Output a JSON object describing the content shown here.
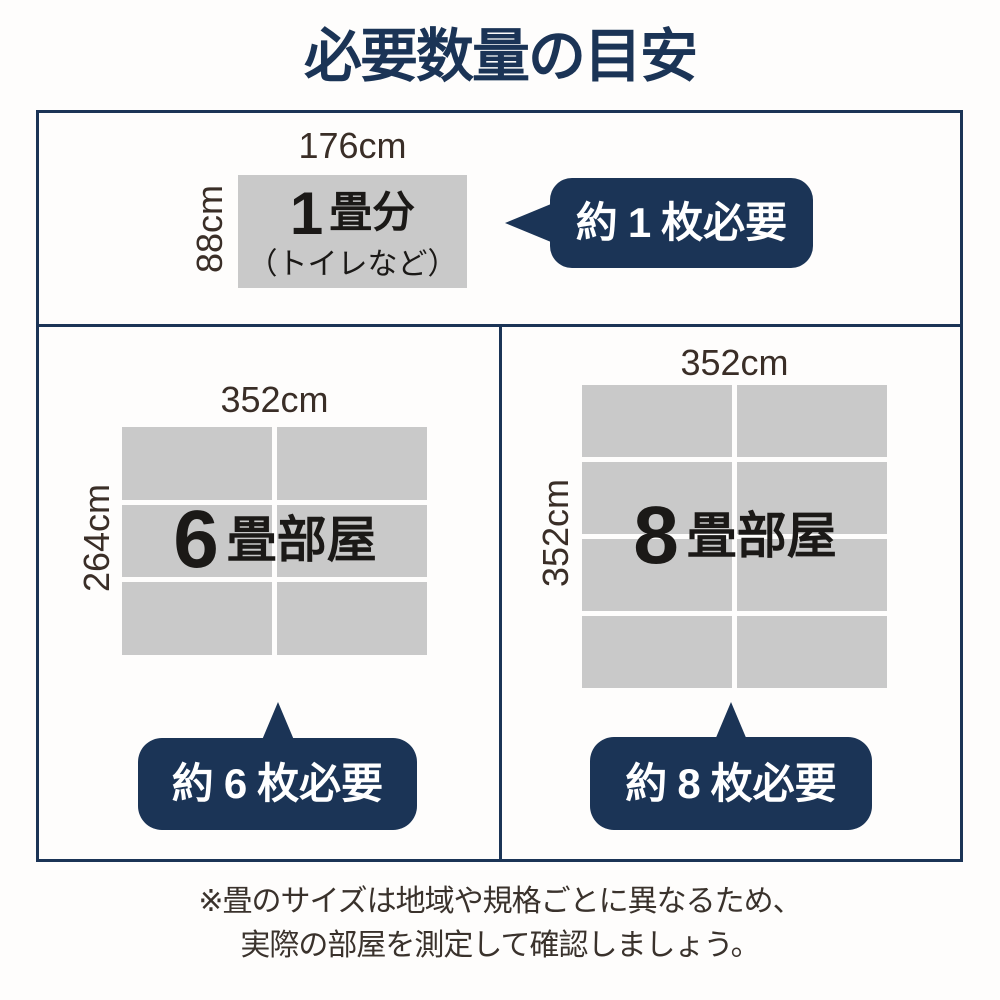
{
  "title": "必要数量の目安",
  "colors": {
    "navy": "#1b3456",
    "cell_gray": "#c9c9c9",
    "ink": "#1b1917",
    "dim_label": "#3a2e27",
    "footer_text": "#3a322c",
    "bg": "#fefdfc",
    "bubble_text": "#ffffff"
  },
  "one_tatami": {
    "width_label": "176cm",
    "height_label": "88cm",
    "number": "1",
    "unit": "畳分",
    "note": "（トイレなど）",
    "bubble": {
      "prefix": "約",
      "count": "1",
      "suffix": "枚必要"
    }
  },
  "six_tatami": {
    "width_label": "352cm",
    "height_label": "264cm",
    "number": "6",
    "room": "畳部屋",
    "grid": {
      "cols": 2,
      "rows": 3
    },
    "bubble": {
      "prefix": "約",
      "count": "6",
      "suffix": "枚必要"
    }
  },
  "eight_tatami": {
    "width_label": "352cm",
    "height_label": "352cm",
    "number": "8",
    "room": "畳部屋",
    "grid": {
      "cols": 2,
      "rows": 4
    },
    "bubble": {
      "prefix": "約",
      "count": "8",
      "suffix": "枚必要"
    }
  },
  "footer": {
    "line1": "※畳のサイズは地域や規格ごとに異なるため、",
    "line2": "実際の部屋を測定して確認しましょう。"
  }
}
